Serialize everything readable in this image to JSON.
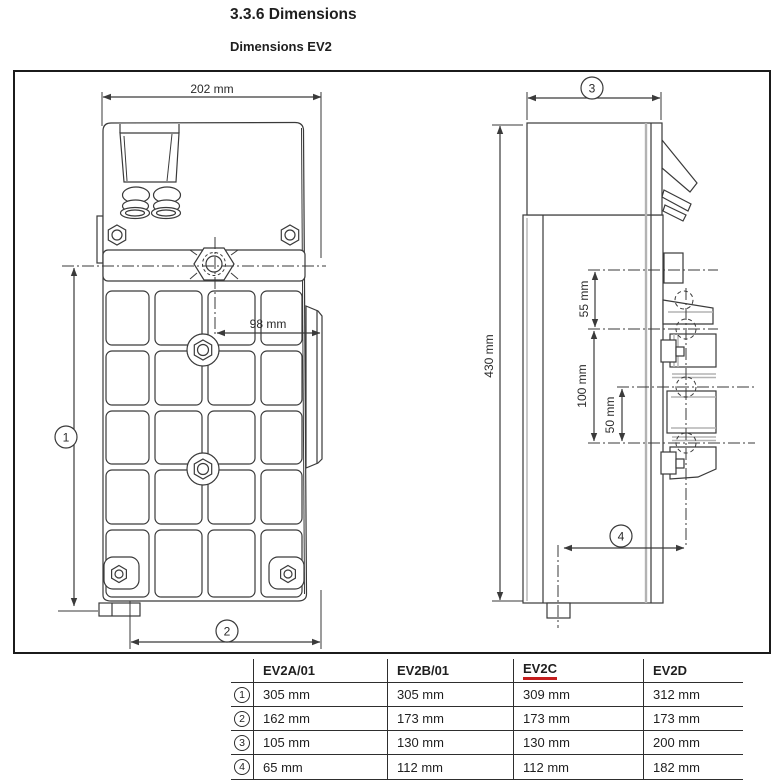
{
  "page": {
    "section_title": "3.3.6 Dimensions",
    "figure_title": "Dimensions EV2"
  },
  "figure": {
    "front_view": {
      "width_label": "202 mm",
      "hole_offset_label": "98 mm"
    },
    "side_view": {
      "height_label": "430 mm",
      "spacing_top_label": "55 mm",
      "spacing_label": "100 mm",
      "spacing_half_label": "50 mm"
    },
    "refs": [
      "1",
      "2",
      "3",
      "4"
    ]
  },
  "table": {
    "columns": [
      "EV2A/01",
      "EV2B/01",
      "EV2C",
      "EV2D"
    ],
    "highlighted_column": "EV2C",
    "rows": [
      {
        "ref": "1",
        "values": [
          "305 mm",
          "305 mm",
          "309 mm",
          "312 mm"
        ]
      },
      {
        "ref": "2",
        "values": [
          "162 mm",
          "173 mm",
          "173 mm",
          "173 mm"
        ]
      },
      {
        "ref": "3",
        "values": [
          "105 mm",
          "130 mm",
          "130 mm",
          "200 mm"
        ]
      },
      {
        "ref": "4",
        "values": [
          "65 mm",
          "112 mm",
          "112 mm",
          "182 mm"
        ]
      }
    ]
  },
  "colors": {
    "line": "#3a3a3a",
    "highlight_underline": "#c41e1e"
  }
}
